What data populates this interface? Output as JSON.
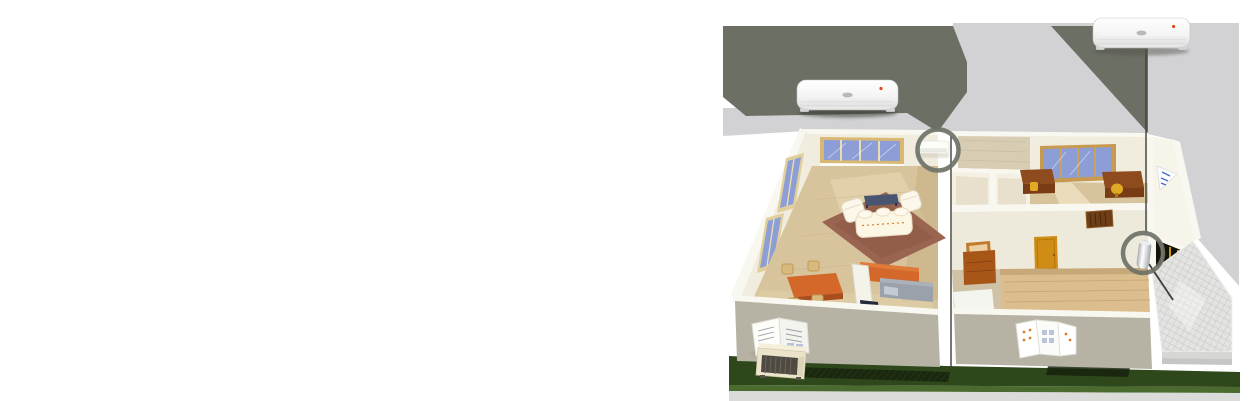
{
  "scene": {
    "description": "3D isometric cutaway illustration of a single-storey home showing installed split air-conditioner indoor units, highlighted by circle callouts connected to two enlarged wall-mounted units floating above the house",
    "regions": [
      "living-room",
      "kitchen-dining",
      "study-office",
      "bedroom-hall",
      "entrance-patio",
      "lawn"
    ],
    "callouts": [
      {
        "name": "living-room-indoor-unit",
        "marker": "circle-ring",
        "connector": "shadow-beam"
      },
      {
        "name": "hall-floor-unit",
        "marker": "circle-ring",
        "connector": "vertical-line"
      }
    ],
    "products": [
      {
        "name": "enlarged-indoor-unit-left",
        "type": "wall-mounted-split-ac-indoor-unit"
      },
      {
        "name": "enlarged-indoor-unit-right",
        "type": "wall-mounted-split-ac-indoor-unit"
      },
      {
        "name": "small-indoor-unit-on-wall",
        "type": "wall-mounted-split-ac-indoor-unit"
      },
      {
        "name": "floor-cylinder-unit",
        "type": "floor-standing-unit"
      },
      {
        "name": "outdoor-condenser-unit",
        "type": "ac-outdoor-unit"
      }
    ]
  },
  "colors": {
    "backdrop_light": "#d2d2d5",
    "backdrop_dark": "#6b6f64",
    "callout_ring": "#6e7267",
    "leader_line": "#3f3f38",
    "wall_interior": "#f1edde",
    "wall_interior2": "#eeeadb",
    "wall_top": "#f8f7f0",
    "wall_exterior": "#b7b3a4",
    "floor_tan": "#d8c49c",
    "floor_wood": "#dcbd8d",
    "rug": "#9a6550",
    "glass_blue": "#8d9ed6",
    "glass_dark": "#243a66",
    "window_frame": "#d9b873",
    "accent_orange": "#d4682a",
    "counter_gray": "#9aa1aa",
    "door_orange": "#cf8d16",
    "desk_brown": "#8d4b1e",
    "chair_yellow": "#e2aa22",
    "lawn_green": "#2e481c",
    "lawn_edge": "#4a6a30",
    "tile_gray": "#e3e3e1",
    "unit_indicator_red": "#e04818",
    "unit_logo_gray": "#b8b8b8"
  }
}
